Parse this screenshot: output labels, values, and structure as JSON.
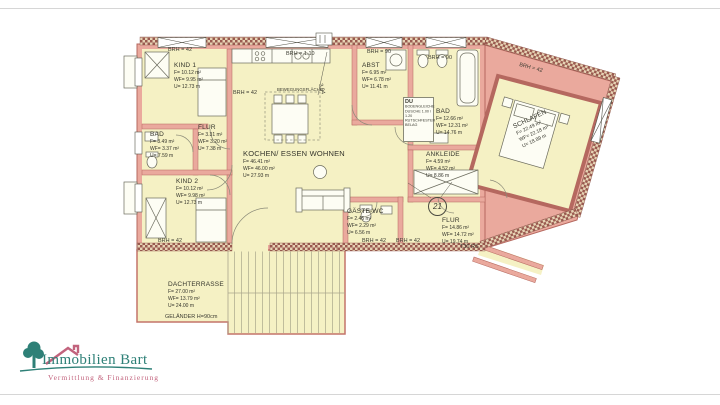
{
  "page": {
    "background": "#ffffff",
    "colors": {
      "wall_fill": "#eaa99d",
      "wall_line": "#b5685f",
      "room_fill": "#f5f1c4",
      "hatch_dark": "#9a5a50",
      "hatch_light": "#e6d3b4",
      "fixture_fill": "#fdfdf4",
      "fixture_line": "#6b6b5d",
      "logo_teal": "#2e8077",
      "logo_rose": "#c2637d"
    }
  },
  "plan": {
    "rooms": {
      "kind1": {
        "name": "KIND 1",
        "f": "F= 10.12 m²",
        "wf": "WF= 9.95 m²",
        "u": "U= 12.73 m"
      },
      "bad1": {
        "name": "BAD",
        "f": "F= 3.49 m²",
        "wf": "WF= 3.37 m²",
        "u": "U= 7.59 m"
      },
      "flur1": {
        "name": "FLUR",
        "f": "F= 3.31 m²",
        "wf": "WF= 3.20 m²",
        "u": "U= 7.38 m"
      },
      "kind2": {
        "name": "KIND 2",
        "f": "F= 10.12 m²",
        "wf": "WF= 9.98 m²",
        "u": "U= 12.73 m"
      },
      "wohnen": {
        "name": "KOCHEN/ ESSEN WOHNEN",
        "f": "F= 46.41 m²",
        "wf": "WF= 46.00 m²",
        "u": "U= 27.93 m"
      },
      "abst": {
        "name": "ABST",
        "f": "F= 6.95 m²",
        "wf": "WF= 6.78 m²",
        "u": "U= 11.41 m"
      },
      "bad2": {
        "name": "BAD",
        "f": "F= 12.66 m²",
        "wf": "WF= 12.31 m²",
        "u": "U= 14.76 m"
      },
      "ankleide": {
        "name": "ANKLEIDE",
        "f": "F= 4.59 m²",
        "wf": "WF= 4.52 m²",
        "u": "U= 8.86 m"
      },
      "schlafen": {
        "name": "SCHLAFEN",
        "f": "F= 22.49 m²",
        "wf": "WF= 22.18 m²",
        "u": "U= 18.89 m"
      },
      "gaestewc": {
        "name": "GÄSTE-WC",
        "f": "F= 2.45 m²",
        "wf": "WF= 2.29 m²",
        "u": "U= 6.56 m"
      },
      "flur2": {
        "name": "FLUR",
        "f": "F= 14.86 m²",
        "wf": "WF= 14.72 m²",
        "u": "U= 19.74 m"
      },
      "terrasse": {
        "name": "DACHTERRASSE",
        "f": "F= 27.00 m²",
        "wf": "WF= 13.79 m²",
        "u": "U= 24.00 m"
      }
    },
    "annotations": {
      "brh42": "BRH = 42",
      "brh110": "BRH = 1.10",
      "brh90": "BRH = 90",
      "gelaender": "GELÄNDER H=90cm",
      "t30": "T30 RS",
      "nr21": "21",
      "dim394": "3,94",
      "bewegung": "BEWEGUNGSFLÄCHE",
      "du": "DU",
      "du_note": "BODENGLEICHE DUSCHE 1.00 / 1.20 RUTSCHFESTER BELAG"
    }
  },
  "logo": {
    "title": "Immobilien Bart",
    "subtitle": "Vermittlung & Finanzierung"
  }
}
